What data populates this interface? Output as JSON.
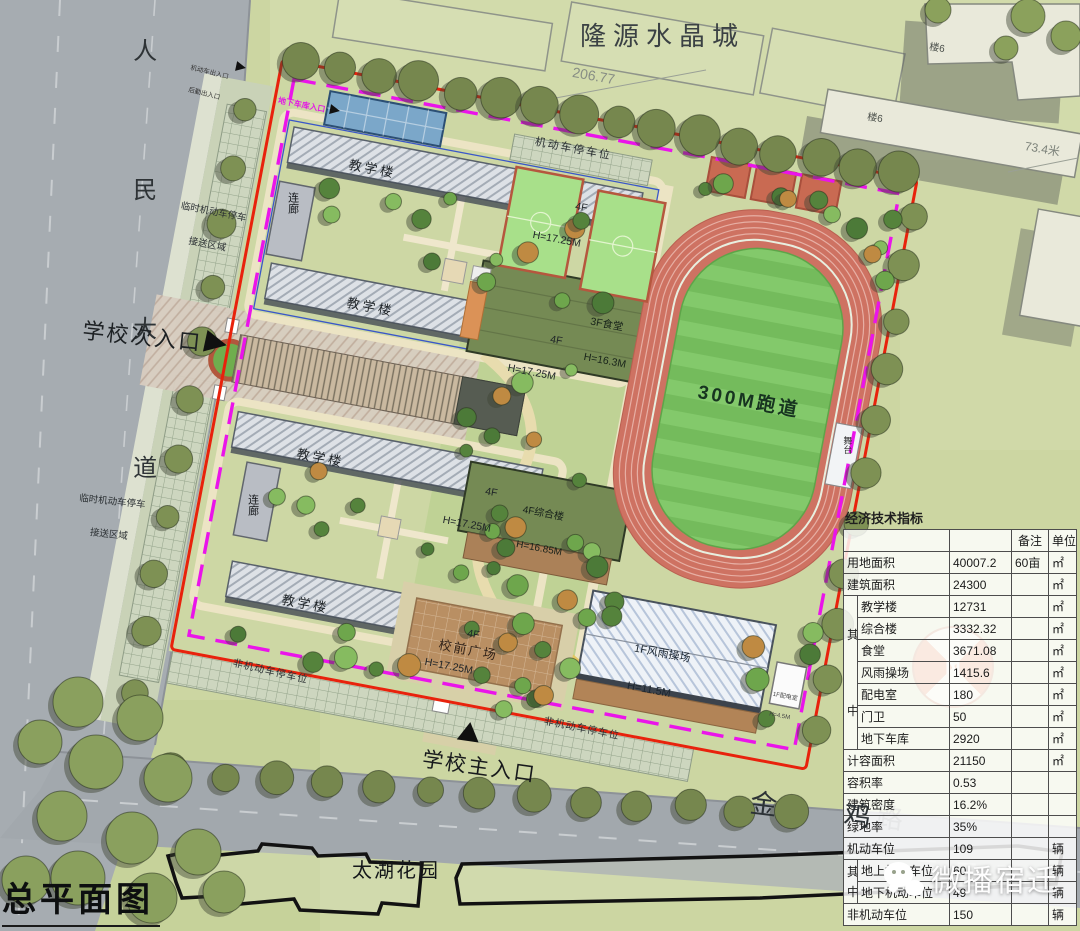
{
  "page": {
    "title": "总平面图"
  },
  "watermark": {
    "text": "微播宿迁"
  },
  "roads": {
    "west_vertical": "人民大道",
    "south_name": "金 鸡",
    "south_name_hidden": "路"
  },
  "surroundings": {
    "north_estate": "隆源水晶城",
    "south_estate": "太湖花园",
    "building_tag": "楼6",
    "dim_top": "206.77",
    "dim_right": "73.4米"
  },
  "entrances": {
    "main": "学校主入口",
    "secondary": "学校次入口",
    "garage": "地下车库入口",
    "service_line1": "机动车出入口",
    "service_line2": "后勤出入口"
  },
  "labels": {
    "teaching": "教学楼",
    "teaching_spec_line1": "4F",
    "teaching_spec_line2": "H=17.25M",
    "corridor": "连廊",
    "canteen_line1": "3F食堂",
    "canteen_line2": "H=16.3M",
    "complex_line1": "4F综合楼",
    "complex_line2": "H=16.85M",
    "gym_line1": "1F风雨操场",
    "gym_line2": "H=11.5M",
    "substation_line1": "1F配电室",
    "substation_line2": "H=4.5M",
    "track": "300M跑道",
    "stage": "舞台",
    "plaza": "校前广场",
    "parking_motor": "机动车停车位",
    "parking_nonmotor": "非机动车停车位",
    "parking_temp_line1": "临时机动车停车",
    "parking_temp_line2": "接送区域",
    "compass_n": "N"
  },
  "table": {
    "title": "经济技术指标",
    "header_remark": "备注",
    "header_unit": "单位",
    "group_char1": "其",
    "group_char2": "中",
    "rows": {
      "land": {
        "label": "用地面积",
        "value": "40007.2",
        "remark": "60亩",
        "unit": "㎡"
      },
      "gfa": {
        "label": "建筑面积",
        "value": "24300",
        "unit": "㎡"
      },
      "teach": {
        "label": "教学楼",
        "value": "12731",
        "unit": "㎡"
      },
      "complex": {
        "label": "综合楼",
        "value": "3332.32",
        "unit": "㎡"
      },
      "canteen": {
        "label": "食堂",
        "value": "3671.08",
        "unit": "㎡"
      },
      "gym": {
        "label": "风雨操场",
        "value": "1415.6",
        "unit": "㎡"
      },
      "substation": {
        "label": "配电室",
        "value": "180",
        "unit": "㎡"
      },
      "guard": {
        "label": "门卫",
        "value": "50",
        "unit": "㎡"
      },
      "garage": {
        "label": "地下车库",
        "value": "2920",
        "unit": "㎡"
      },
      "plot_gfa": {
        "label": "计容面积",
        "value": "21150",
        "unit": "㎡"
      },
      "far": {
        "label": "容积率",
        "value": "0.53"
      },
      "density": {
        "label": "建筑密度",
        "value": "16.2%"
      },
      "green": {
        "label": "绿地率",
        "value": "35%"
      },
      "motor": {
        "label": "机动车位",
        "value": "109",
        "unit": "辆"
      },
      "motor_above": {
        "label": "地上机动车位",
        "value": "60",
        "unit": "辆"
      },
      "motor_below": {
        "label": "地下机动车位",
        "value": "49",
        "unit": "辆"
      },
      "nonmotor": {
        "label": "非机动车位",
        "value": "150",
        "unit": "辆"
      }
    }
  },
  "colors": {
    "boundary_red": "#e8220c",
    "boundary_magenta": "#ea14ea",
    "track_red": "#ce7262",
    "field_green": "#7cc163"
  }
}
